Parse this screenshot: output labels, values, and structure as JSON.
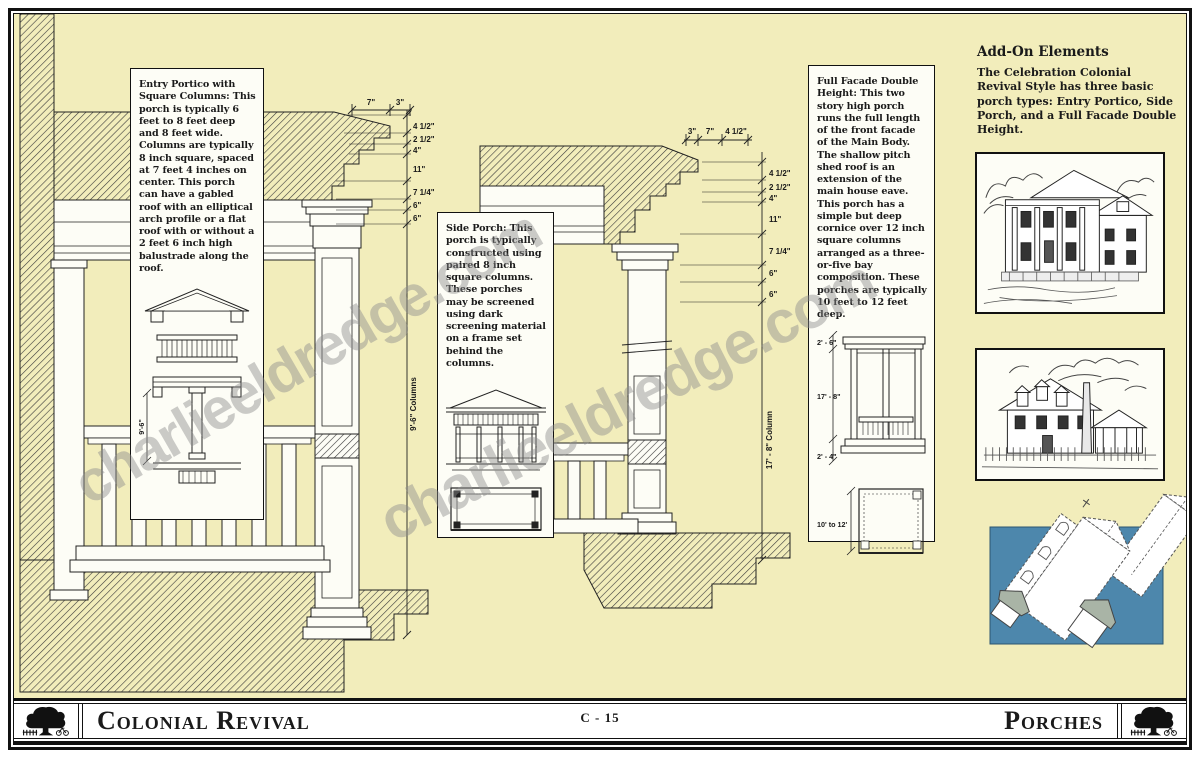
{
  "page": {
    "watermark": "charlieeldredge.com",
    "colors": {
      "paper": "#f2edbb",
      "panel_blue": "#4d87ac",
      "ink": "#1a1a1a",
      "box_bg": "#fdfdf6"
    }
  },
  "text_boxes": {
    "entry_portico": {
      "title": "Entry Portico with Square Columns",
      "body": ": This porch is typically 6 feet to 8 feet deep and 8 feet wide. Columns are typically 8 inch square, spaced at 7 feet 4 inches on center. This porch can have a gabled roof with an elliptical arch profile or a flat roof with or without a 2 feet 6 inch high balustrade along the roof.",
      "column_dim": "9'-6\""
    },
    "side_porch": {
      "title": "Side Porch",
      "body": ": This porch is typically constructed using paired 8 inch square columns. These porches may be screened using dark screening material on a frame set behind the columns."
    },
    "full_facade": {
      "title": "Full Facade Double Height",
      "body": ": This two story high porch runs the full length of the front facade of the Main Body. The shallow pitch shed roof is an extension of the main house eave. This porch has a simple but deep cornice over 12 inch square columns arranged as a three-or-five bay composition. These porches are typically 10 feet to 12 feet deep.",
      "dims": {
        "cornice": "2' - 6\"",
        "column": "17' - 8\"",
        "base": "2' - 4\"",
        "depth": "10' to 12'"
      }
    }
  },
  "addon": {
    "heading": "Add-On Elements",
    "body": "The Celebration Colonial Revival Style has three basic porch types: Entry Portico, Side Porch, and a Full Facade Double Height."
  },
  "left_drawing": {
    "top_dims": [
      "7\"",
      "3\""
    ],
    "side_dims": [
      "4 1/2\"",
      "2 1/2\"",
      "4\"",
      "11\"",
      "7 1/4\"",
      "6\"",
      "6\""
    ],
    "column_label": "9'-6\" Columns"
  },
  "middle_drawing": {
    "top_dims": [
      "3\"",
      "7\"",
      "4 1/2\""
    ],
    "side_dims": [
      "4 1/2\"",
      "2 1/2\"",
      "4\"",
      "11\"",
      "7 1/4\"",
      "6\"",
      "6\""
    ],
    "column_label": "17' - 8\" Column"
  },
  "footer": {
    "left_title": "Colonial Revival",
    "page_code": "C - 15",
    "right_title": "Porches"
  }
}
